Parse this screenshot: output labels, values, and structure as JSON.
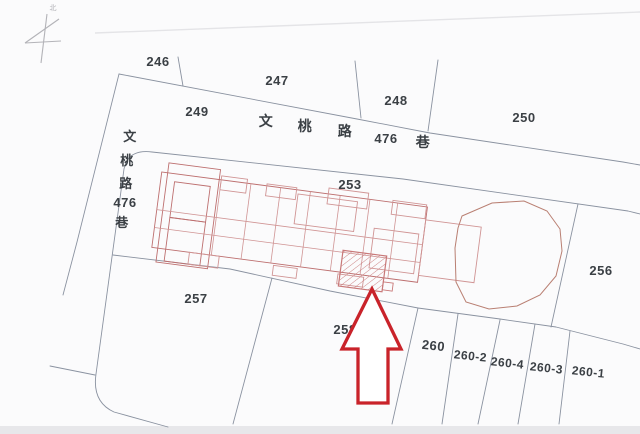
{
  "map": {
    "title": "cadastral-parcel-map",
    "colors": {
      "background": "#fbfbfc",
      "boundary": "#8a92a0",
      "building": "#bd6f6f",
      "building_light": "#d09494",
      "hatch": "#c87878",
      "blob": "#b97f72",
      "arrow": "#c9232a",
      "text": "#3b4045",
      "faint": "#e4e4e7",
      "scan_band": "#e7e7ea",
      "north": "#b3b3b8"
    },
    "north": {
      "label": "北",
      "label_x": 53,
      "label_y": 10,
      "lines": [
        [
          47,
          14,
          41,
          63
        ],
        [
          59,
          19,
          25,
          43
        ],
        [
          25,
          43,
          61,
          41
        ]
      ]
    },
    "parcel_labels": [
      {
        "name": "parcel-label-246",
        "text": "246",
        "x": 158,
        "y": 66,
        "size": 13,
        "rotate": 0
      },
      {
        "name": "parcel-label-247",
        "text": "247",
        "x": 277,
        "y": 85,
        "size": 13,
        "rotate": 0
      },
      {
        "name": "parcel-label-248",
        "text": "248",
        "x": 396,
        "y": 105,
        "size": 13,
        "rotate": 0
      },
      {
        "name": "parcel-label-249",
        "text": "249",
        "x": 197,
        "y": 116,
        "size": 13,
        "rotate": 0
      },
      {
        "name": "parcel-label-250",
        "text": "250",
        "x": 524,
        "y": 122,
        "size": 13,
        "rotate": 0
      },
      {
        "name": "parcel-label-253",
        "text": "253",
        "x": 350,
        "y": 189,
        "size": 13,
        "rotate": 0
      },
      {
        "name": "parcel-label-256",
        "text": "256",
        "x": 601,
        "y": 275,
        "size": 13,
        "rotate": 0
      },
      {
        "name": "parcel-label-257",
        "text": "257",
        "x": 196,
        "y": 303,
        "size": 13,
        "rotate": 0
      },
      {
        "name": "parcel-label-258",
        "text": "258",
        "x": 345,
        "y": 334,
        "size": 13,
        "rotate": 0
      },
      {
        "name": "parcel-label-260",
        "text": "260",
        "x": 433,
        "y": 350,
        "size": 13,
        "rotate": 6
      },
      {
        "name": "parcel-label-260-2",
        "text": "260-2",
        "x": 470,
        "y": 360,
        "size": 12,
        "rotate": 6
      },
      {
        "name": "parcel-label-260-4",
        "text": "260-4",
        "x": 507,
        "y": 367,
        "size": 12,
        "rotate": 6
      },
      {
        "name": "parcel-label-260-3",
        "text": "260-3",
        "x": 546,
        "y": 372,
        "size": 12,
        "rotate": 6
      },
      {
        "name": "parcel-label-260-1",
        "text": "260-1",
        "x": 588,
        "y": 376,
        "size": 12,
        "rotate": 6
      }
    ],
    "road_labels": [
      {
        "name": "road-label-h-1",
        "text": "文",
        "x": 266,
        "y": 126,
        "size": 14,
        "bold": false
      },
      {
        "name": "road-label-h-2",
        "text": "桃",
        "x": 305,
        "y": 131,
        "size": 14,
        "bold": false
      },
      {
        "name": "road-label-h-3",
        "text": "路",
        "x": 345,
        "y": 136,
        "size": 14,
        "bold": false
      },
      {
        "name": "road-label-h-4",
        "text": "476",
        "x": 386,
        "y": 143,
        "size": 13,
        "bold": true
      },
      {
        "name": "road-label-h-5",
        "text": "巷",
        "x": 423,
        "y": 147,
        "size": 14,
        "bold": false
      },
      {
        "name": "road-label-v-1",
        "text": "文",
        "x": 130,
        "y": 141,
        "size": 13,
        "bold": false
      },
      {
        "name": "road-label-v-2",
        "text": "桃",
        "x": 127,
        "y": 165,
        "size": 13,
        "bold": false
      },
      {
        "name": "road-label-v-3",
        "text": "路",
        "x": 126,
        "y": 188,
        "size": 13,
        "bold": false
      },
      {
        "name": "road-label-v-4",
        "text": "476",
        "x": 125,
        "y": 207,
        "size": 13,
        "bold": true
      },
      {
        "name": "road-label-v-5",
        "text": "巷",
        "x": 122,
        "y": 227,
        "size": 13,
        "bold": false
      }
    ],
    "boundaries": [
      {
        "name": "boundary-west-road-edge",
        "points": "119,74 77,242 63,295"
      },
      {
        "name": "boundary-north-block-south-edge",
        "points": "119,74 357,119 430,133 623,162 640,165"
      },
      {
        "name": "boundary-246-247",
        "points": "178,57 183,86"
      },
      {
        "name": "boundary-247-248",
        "points": "355,61 361,118"
      },
      {
        "name": "boundary-248-250",
        "points": "438,60 428,131"
      },
      {
        "name": "boundary-center-block-outline",
        "d": "M 640,214 L 628,211 L 403,179 L 152,152 Q 128,149 124,169 L 96,374 Q 92,402 114,412 L 168,427"
      },
      {
        "name": "boundary-south-edge",
        "points": "113,255 230,269 330,291 418,308 500,319 556,327 623,344 640,349"
      },
      {
        "name": "boundary-256-west",
        "points": "578,204 551,327"
      },
      {
        "name": "boundary-257-258",
        "points": "272,278 233,424"
      },
      {
        "name": "boundary-258-260",
        "points": "418,308 392,424"
      },
      {
        "name": "boundary-260-260-2",
        "points": "458,314 442,424"
      },
      {
        "name": "boundary-260-2-260-4",
        "points": "500,320 478,424"
      },
      {
        "name": "boundary-260-4-260-3",
        "points": "535,324 518,424"
      },
      {
        "name": "boundary-260-3-260-1",
        "points": "570,331 559,424"
      },
      {
        "name": "boundary-west-stub",
        "points": "50,366 95,375"
      }
    ],
    "buildings": {
      "angle": 7.5,
      "ox": 162,
      "oy": 170,
      "rects": [
        [
          162,
          172,
          268,
          76
        ],
        [
          168,
          162,
          52,
          100
        ],
        [
          176,
          180,
          36,
          36
        ],
        [
          176,
          216,
          36,
          44
        ],
        [
          222,
          168,
          26,
          14
        ],
        [
          268,
          170,
          30,
          12
        ],
        [
          330,
          166,
          40,
          16
        ],
        [
          395,
          170,
          34,
          14
        ],
        [
          200,
          248,
          30,
          12
        ],
        [
          285,
          250,
          24,
          10
        ],
        [
          350,
          250,
          26,
          10
        ],
        [
          430,
          185,
          56,
          56
        ],
        [
          300,
          176,
          60,
          30
        ],
        [
          380,
          200,
          45,
          40
        ]
      ],
      "lines": [
        [
          222,
          172,
          222,
          248
        ],
        [
          252,
          172,
          252,
          248
        ],
        [
          282,
          172,
          282,
          248
        ],
        [
          312,
          172,
          312,
          248
        ],
        [
          342,
          172,
          342,
          248
        ],
        [
          372,
          172,
          372,
          248
        ],
        [
          400,
          172,
          400,
          248
        ],
        [
          162,
          210,
          430,
          210
        ],
        [
          162,
          228,
          430,
          228
        ]
      ],
      "hatch_rect": [
        352,
        226,
        44,
        36
      ],
      "tab_rect": [
        396,
        252,
        10,
        8
      ]
    },
    "blob_points": "462,216 492,203 524,201 547,211 560,229 562,251 556,276 540,295 517,306 489,309 466,302 456,282 455,248 458,228",
    "arrow_points": "372,289 342,349 358,349 358,403 388,403 388,349 401,349",
    "artifacts": {
      "top_line": "95,33 640,12",
      "bottom_band": [
        0,
        426,
        640,
        8
      ]
    }
  }
}
